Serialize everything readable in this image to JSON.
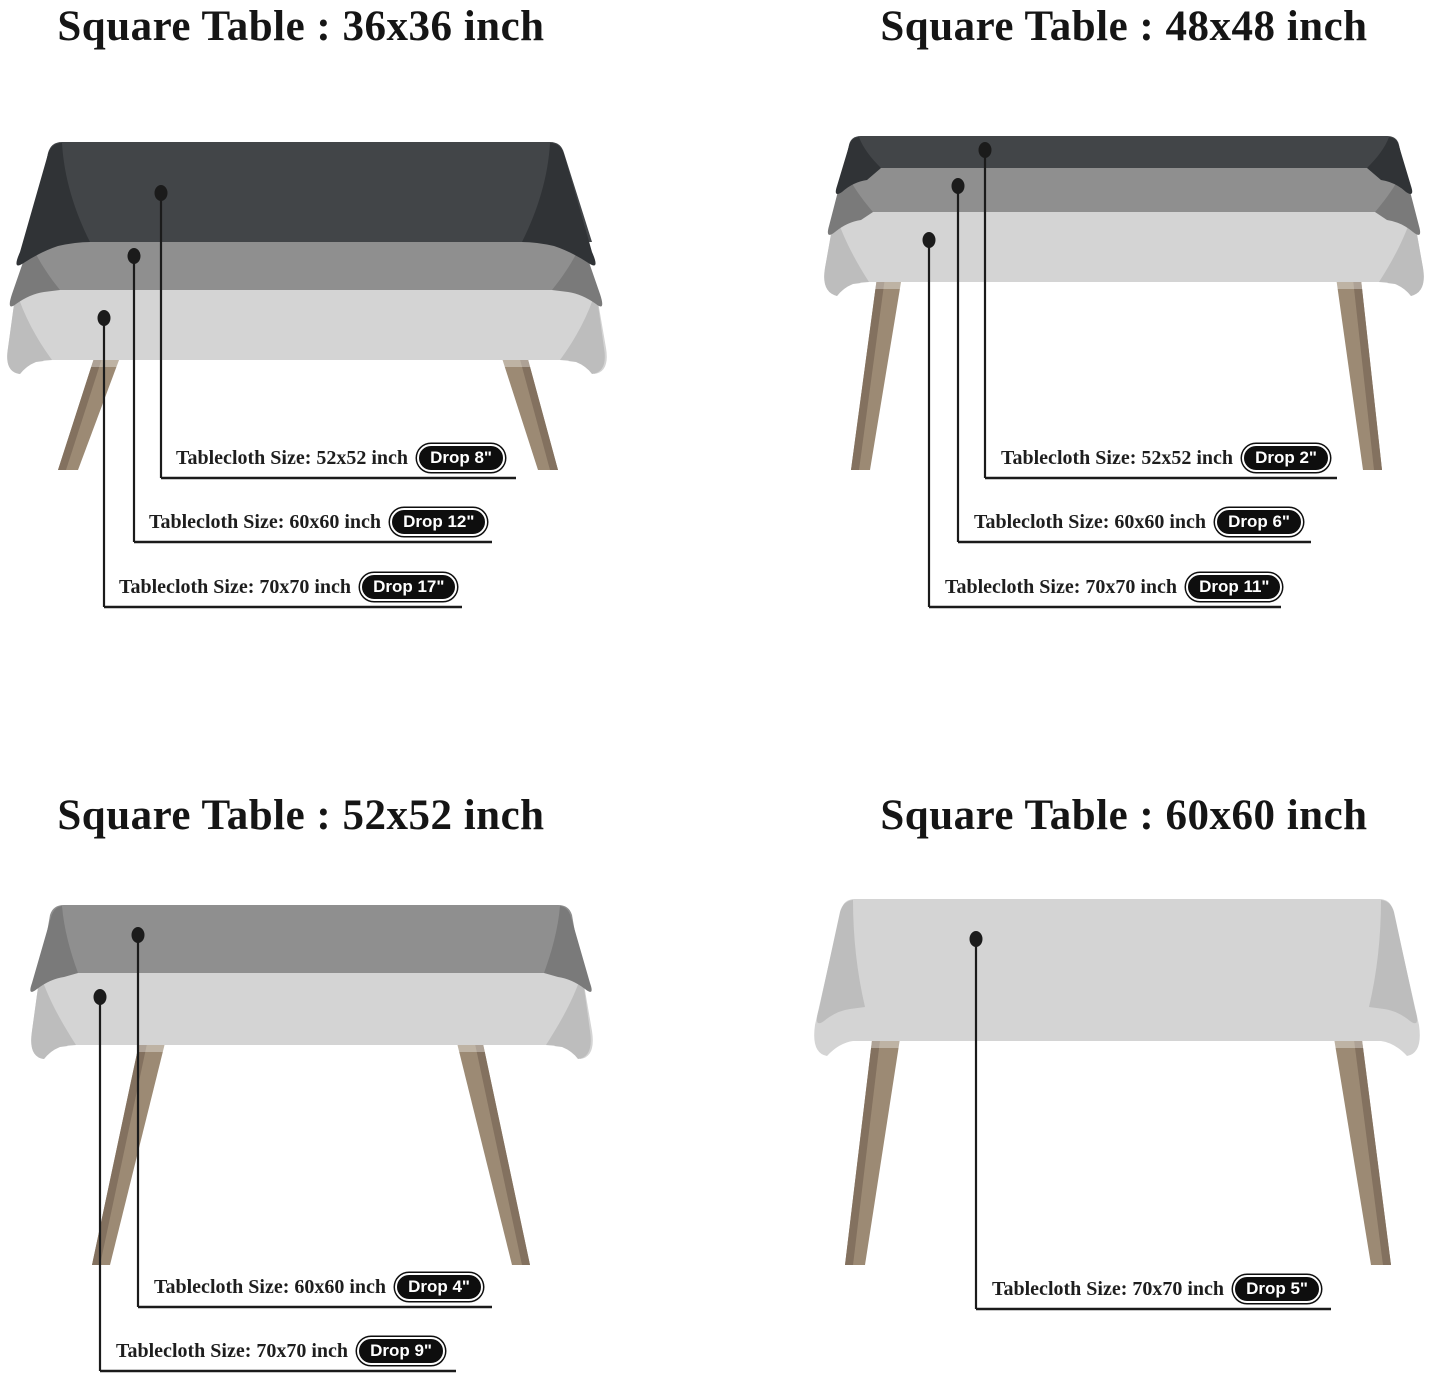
{
  "colors": {
    "background": "#ffffff",
    "title_text": "#151515",
    "label_text": "#1e1e1e",
    "callout_line": "#1b1b1b",
    "badge_background": "#0e0e0e",
    "badge_text": "#ffffff",
    "cloth_52x52": "#424548",
    "cloth_52x52_shade": "#303336",
    "cloth_60x60": "#8f8f8f",
    "cloth_60x60_shade": "#7a7a7a",
    "cloth_70x70": "#d4d4d4",
    "cloth_70x70_shade": "#bdbdbd",
    "table_leg": "#9c8a74",
    "table_leg_shade": "#83715f"
  },
  "sections": [
    {
      "title": "Square Table : 36x36 inch",
      "labels": [
        {
          "text": "Tablecloth Size: 52x52 inch",
          "drop": "Drop 8\""
        },
        {
          "text": "Tablecloth Size: 60x60 inch",
          "drop": "Drop 12\""
        },
        {
          "text": "Tablecloth Size: 70x70 inch",
          "drop": "Drop 17\""
        }
      ]
    },
    {
      "title": "Square Table : 48x48 inch",
      "labels": [
        {
          "text": "Tablecloth Size: 52x52 inch",
          "drop": "Drop 2\""
        },
        {
          "text": "Tablecloth Size: 60x60 inch",
          "drop": "Drop 6\""
        },
        {
          "text": "Tablecloth Size: 70x70 inch",
          "drop": "Drop 11\""
        }
      ]
    },
    {
      "title": "Square Table : 52x52 inch",
      "labels": [
        {
          "text": "Tablecloth Size: 60x60 inch",
          "drop": "Drop 4\""
        },
        {
          "text": "Tablecloth Size: 70x70 inch",
          "drop": "Drop 9\""
        }
      ]
    },
    {
      "title": "Square Table : 60x60 inch",
      "labels": [
        {
          "text": "Tablecloth Size: 70x70 inch",
          "drop": "Drop 5\""
        }
      ]
    }
  ]
}
